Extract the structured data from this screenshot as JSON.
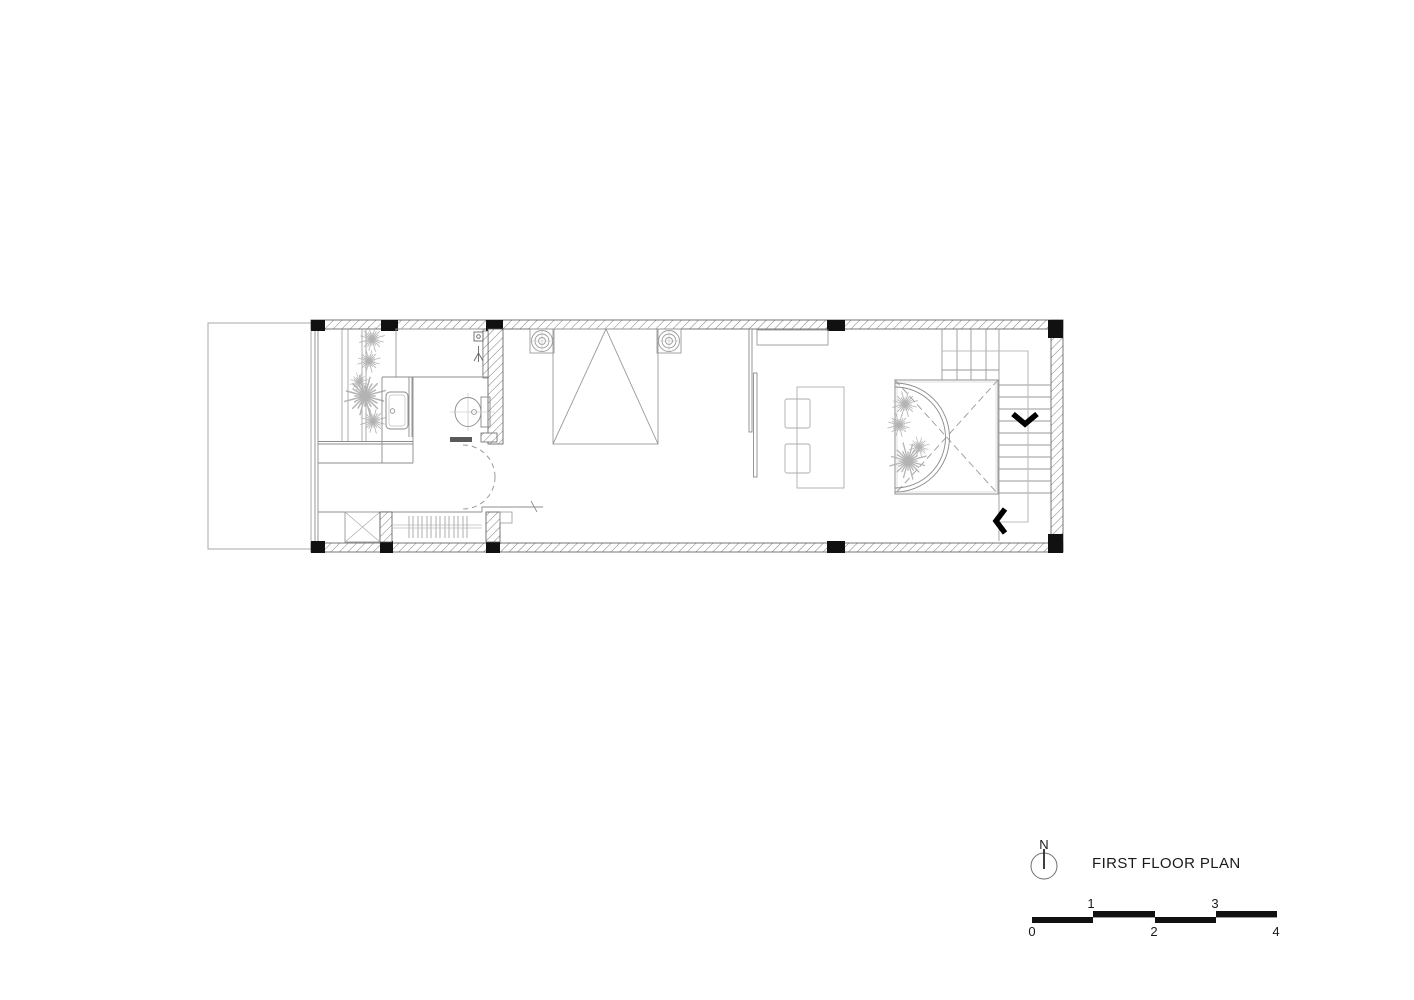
{
  "title_block": {
    "north_label": "N",
    "north_icon": "north-compass-icon",
    "title": "FIRST FLOOR PLAN"
  },
  "scale_bar": {
    "labels": [
      "0",
      "1",
      "2",
      "3",
      "4"
    ]
  },
  "colors": {
    "ink": "#111111",
    "drawing_line": "#8c8c8c",
    "light_line": "#b8b8b8",
    "wall_outline": "#555555"
  }
}
